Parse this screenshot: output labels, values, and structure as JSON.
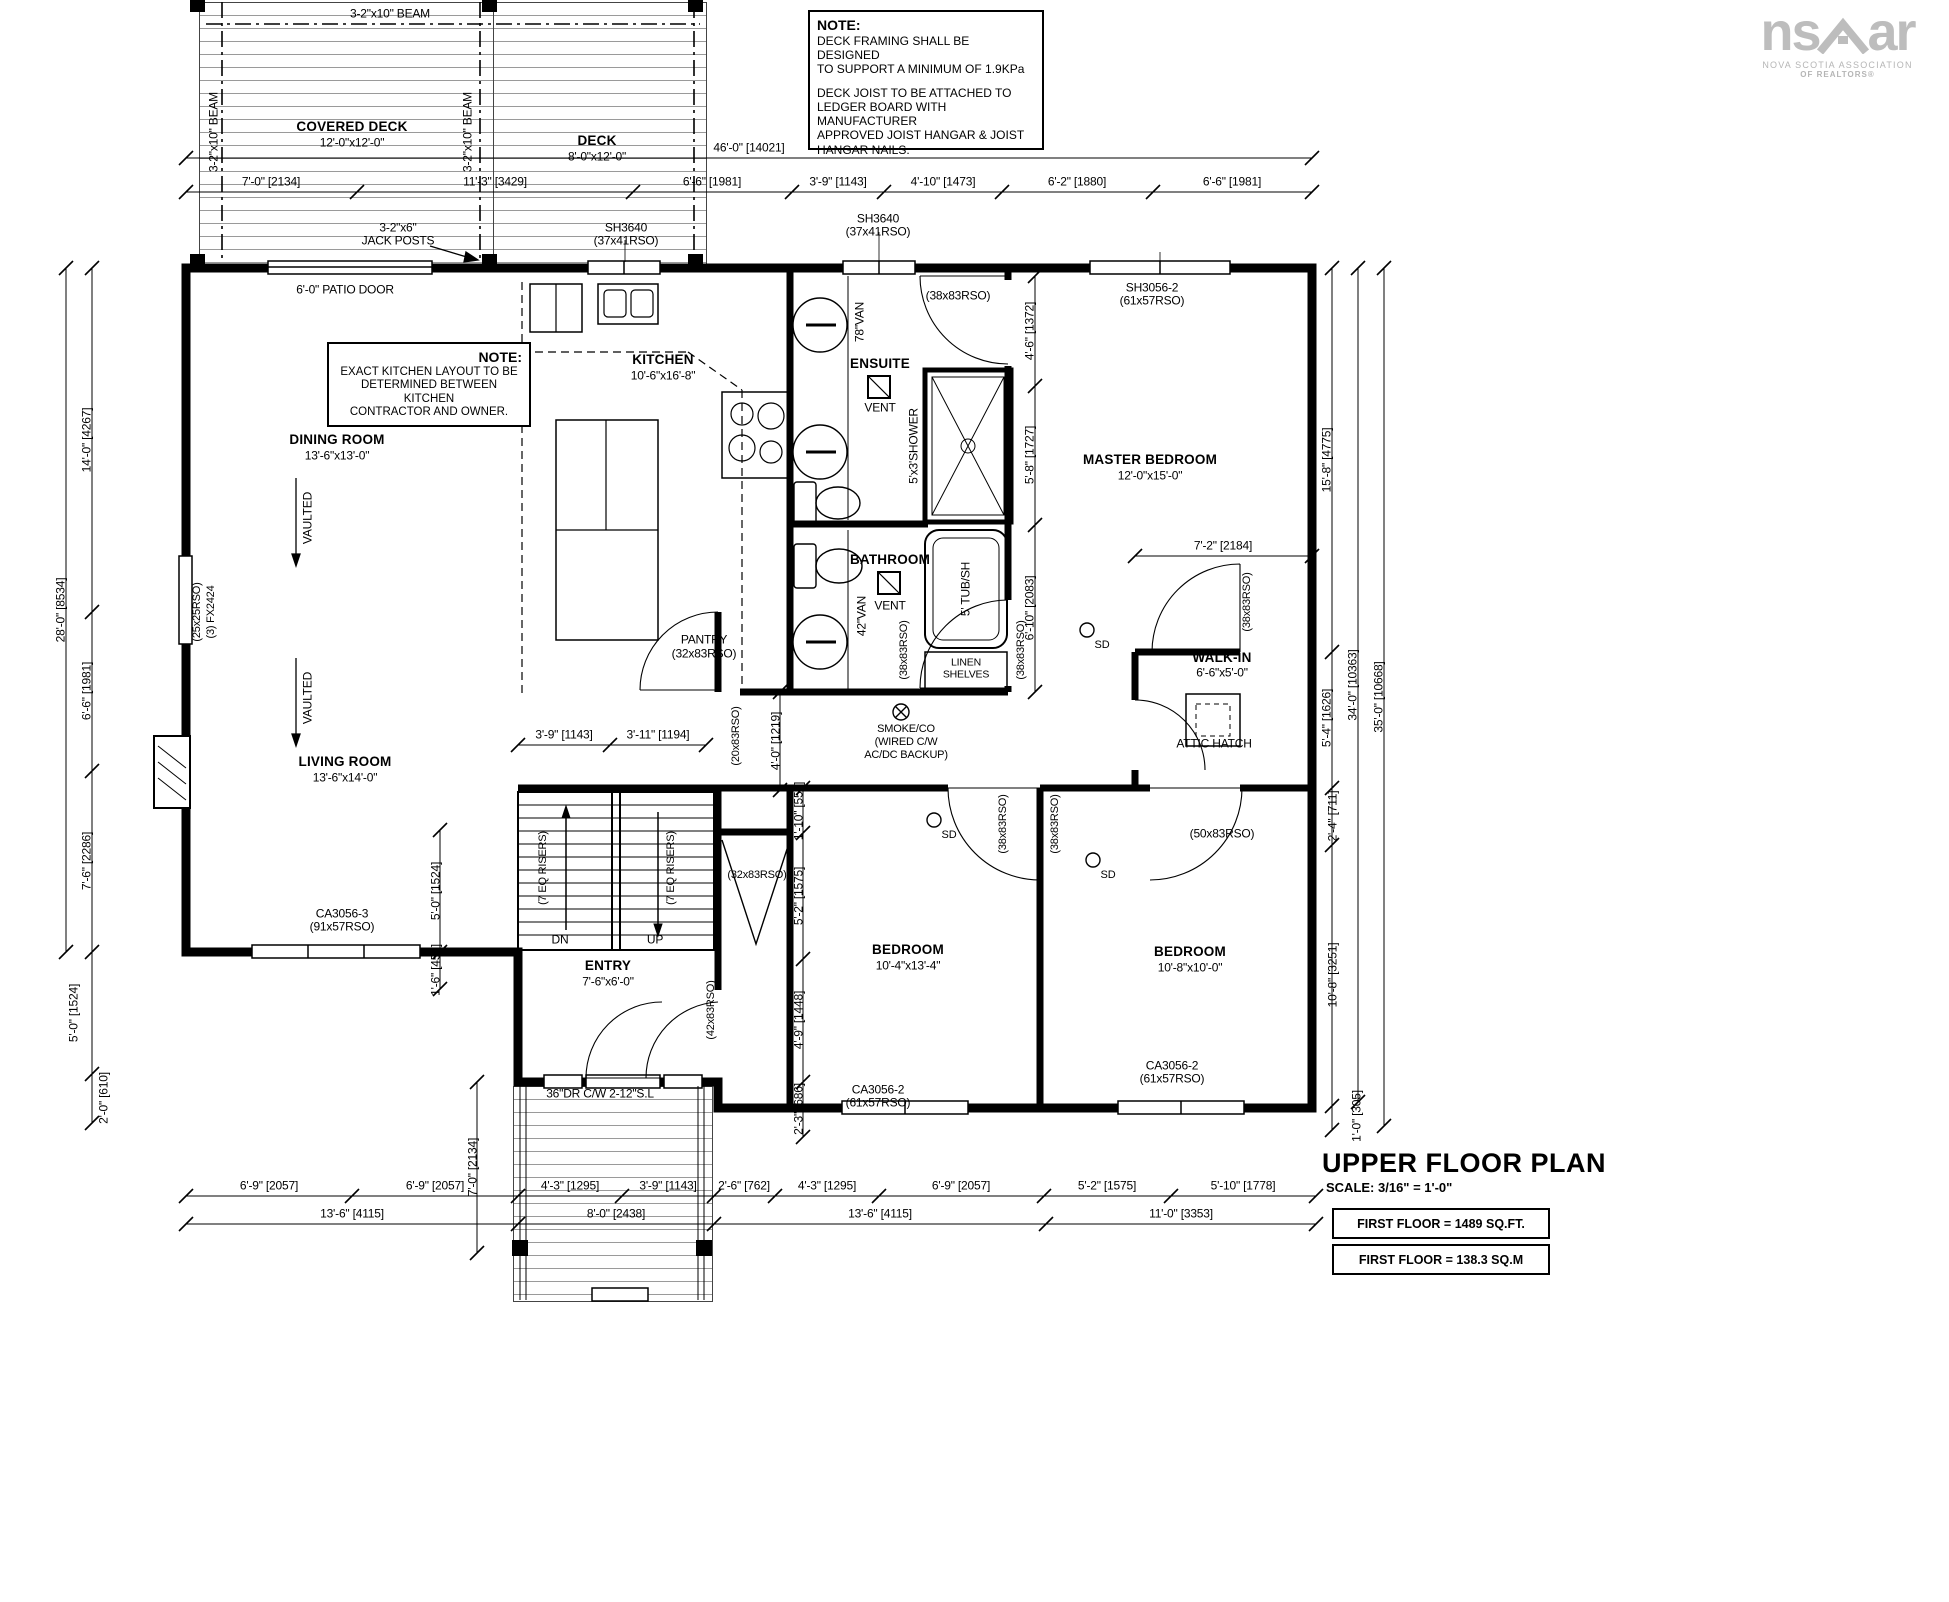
{
  "logo": {
    "brand_left": "ns",
    "brand_right": "ar",
    "tagline1": "NOVA SCOTIA ASSOCIATION",
    "tagline2": "OF REALTORS®"
  },
  "deck_note": {
    "title": "NOTE:",
    "line1": "DECK FRAMING SHALL BE DESIGNED",
    "line2": "TO SUPPORT A MINIMUM OF 1.9KPa",
    "line3": "DECK JOIST TO BE ATTACHED TO",
    "line4": "LEDGER BOARD WITH MANUFACTURER",
    "line5": "APPROVED JOIST HANGAR & JOIST",
    "line6": "HANGAR NAILS."
  },
  "kitchen_note": {
    "title": "NOTE:",
    "line1": "EXACT KITCHEN LAYOUT TO BE",
    "line2": "DETERMINED BETWEEN KITCHEN",
    "line3": "CONTRACTOR AND OWNER."
  },
  "title_block": {
    "title": "UPPER FLOOR PLAN",
    "scale": "SCALE: 3/16\" = 1'-0\"",
    "area_ft": "FIRST FLOOR = 1489 SQ.FT.",
    "area_m": "FIRST FLOOR = 138.3 SQ.M"
  },
  "rooms": {
    "covered_deck": {
      "name": "COVERED DECK",
      "size": "12'-0\"x12'-0\""
    },
    "deck": {
      "name": "DECK",
      "size": "8'-0\"x12'-0\""
    },
    "dining": {
      "name": "DINING ROOM",
      "size": "13'-6\"x13'-0\""
    },
    "kitchen": {
      "name": "KITCHEN",
      "size": "10'-6\"x16'-8\""
    },
    "ensuite": {
      "name": "ENSUITE"
    },
    "master": {
      "name": "MASTER BEDROOM",
      "size": "12'-0\"x15'-0\""
    },
    "bathroom": {
      "name": "BATHROOM"
    },
    "walk_in": {
      "name": "WALK-IN",
      "size": "6'-6\"x5'-0\""
    },
    "living": {
      "name": "LIVING ROOM",
      "size": "13'-6\"x14'-0\""
    },
    "entry": {
      "name": "ENTRY",
      "size": "7'-6\"x6'-0\""
    },
    "bedroom1": {
      "name": "BEDROOM",
      "size": "10'-4\"x13'-4\""
    },
    "bedroom2": {
      "name": "BEDROOM",
      "size": "10'-8\"x10'-0\""
    },
    "pantry": {
      "name": "PANTRY",
      "rso": "(32x83RSO)"
    },
    "linen": {
      "line1": "LINEN",
      "line2": "SHELVES"
    }
  },
  "fixtures": {
    "shower": "5'x3'SHOWER",
    "tub": "5' TUB/SH",
    "vanity78": "78\"VAN",
    "vanity42": "42\"VAN",
    "vent": "VENT",
    "attic": "ATTIC HATCH"
  },
  "stairs": {
    "dn": "DN",
    "up": "UP",
    "risers": "(7 EQ RISERS)"
  },
  "beams": {
    "beam210": "3-2\"x10\" BEAM",
    "jack1": "3-2\"x6\"",
    "jack2": "JACK POSTS"
  },
  "doors": {
    "patio": "6'-0\" PATIO DOOR",
    "front": "36\"DR C/W 2-12\"S.L",
    "rso38": "(38x83RSO)",
    "rso20": "(20x83RSO)",
    "rso32": "(32x83RSO)",
    "rso42": "(42x83RSO)",
    "rso50": "(50x83RSO)"
  },
  "windows": {
    "sh3640": "SH3640",
    "sh3640_rso": "(37x41RSO)",
    "sh3056": "SH3056-2",
    "sh3056_rso": "(61x57RSO)",
    "ca3056_3": "CA3056-3",
    "ca3056_3_rso": "(91x57RSO)",
    "ca3056_2": "CA3056-2",
    "ca3056_2_rso": "(61x57RSO)",
    "fx2424_rso": "(25x25RSO)",
    "fx2424": "(3) FX2424"
  },
  "safety": {
    "sd": "SD",
    "smoke1": "SMOKE/CO",
    "smoke2": "(WIRED C/W",
    "smoke3": "AC/DC BACKUP)"
  },
  "ceiling": {
    "vaulted": "VAULTED"
  },
  "dims": {
    "overall_top": "46'-0\" [14021]",
    "top": [
      "7'-0\" [2134]",
      "11'-3\" [3429]",
      "6'-6\" [1981]",
      "3'-9\" [1143]",
      "4'-10\" [1473]",
      "6'-2\" [1880]",
      "6'-6\" [1981]"
    ],
    "left": [
      "14'-0\" [4267]",
      "28'-0\" [8534]",
      "6'-6\" [1981]",
      "7'-6\" [2286]",
      "5'-0\" [1524]",
      "2'-0\" [610]"
    ],
    "right": [
      "15'-8\" [4775]",
      "5'-4\" [1626]",
      "34'-0\" [10363]",
      "35'-0\" [10668]",
      "2'-4\" [711]",
      "10'-8\" [3251]",
      "1'-0\" [305]"
    ],
    "inner": [
      "4'-6\" [1372]",
      "5'-8\" [1727]",
      "6'-10\" [2083]",
      "7'-2\" [2184]",
      "3'-9\" [1143]",
      "3'-11\" [1194]",
      "4'-0\" [1219]",
      "1'-10\" [559]",
      "5'-2\" [1575]",
      "5'-0\" [1524]",
      "1'-6\" [457]",
      "4'-9\" [1448]",
      "2'-3\" [686]",
      "7'-0\" [2134]"
    ],
    "bottom_segments": [
      "6'-9\" [2057]",
      "6'-9\" [2057]",
      "4'-3\" [1295]",
      "3'-9\" [1143]",
      "2'-6\" [762]",
      "4'-3\" [1295]",
      "6'-9\" [2057]",
      "5'-2\" [1575]",
      "5'-10\" [1778]"
    ],
    "bottom_totals": [
      "13'-6\" [4115]",
      "8'-0\" [2438]",
      "13'-6\" [4115]",
      "11'-0\" [3353]"
    ]
  }
}
